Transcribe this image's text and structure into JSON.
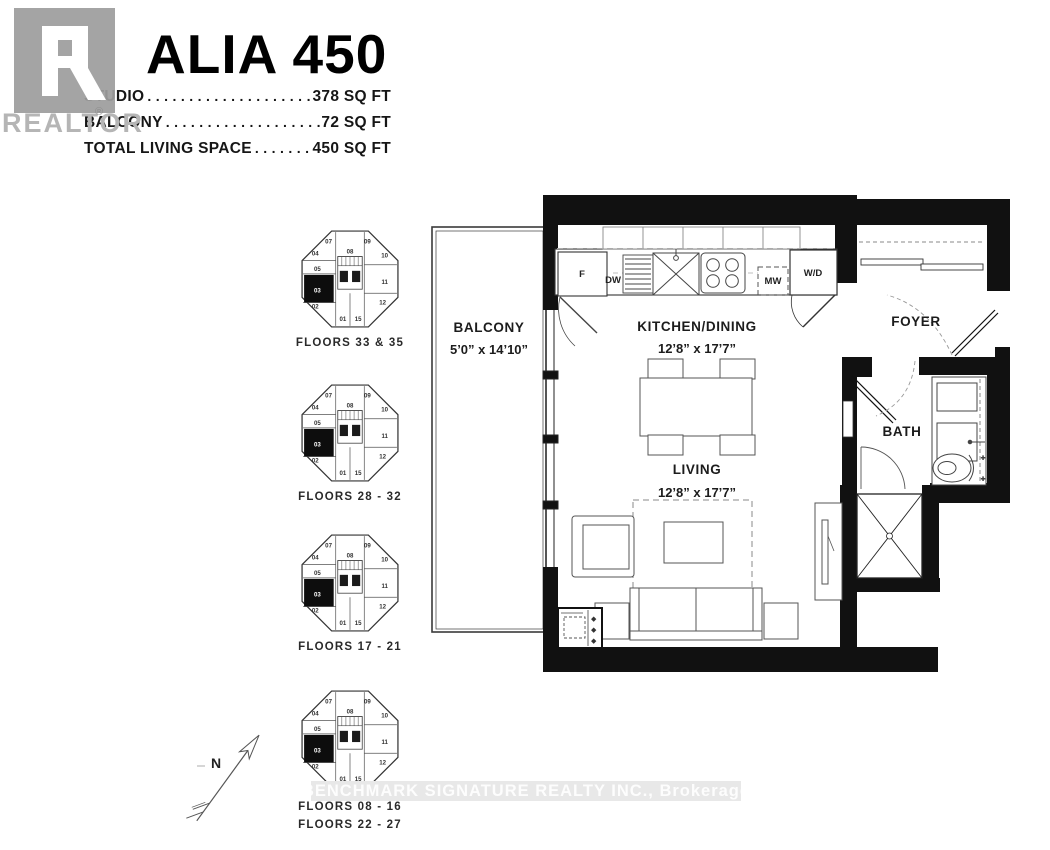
{
  "header": {
    "title": "ALIA 450",
    "specs": [
      {
        "label": "STUDIO",
        "leader": ". . . . . . . . . . . . . . . . . . . . . . . . . . . . . . . .",
        "value": "378 SQ FT"
      },
      {
        "label": "BALCONY",
        "leader": ". . . . . . . . . . . . . . . . . . . . . . . . . . . . . . . .",
        "value": "72 SQ FT"
      },
      {
        "label": "TOTAL LIVING SPACE",
        "leader": ". . . . . . . . . . . . . . . .",
        "value": "450 SQ FT"
      }
    ]
  },
  "watermarks": {
    "realtor": "REALTOR",
    "registered": "®",
    "brokerage": "BENCHMARK SIGNATURE REALTY INC., Brokerage"
  },
  "floor_plan": {
    "balcony": {
      "name": "BALCONY",
      "dims": "5’0” x 14’10”"
    },
    "kitchen_dining": {
      "name": "KITCHEN/DINING",
      "dims": "12’8” x 17’7”"
    },
    "living": {
      "name": "LIVING",
      "dims": "12’8” x 17’7”"
    },
    "foyer": {
      "name": "FOYER"
    },
    "bath": {
      "name": "BATH"
    },
    "appliances": {
      "fridge": "F",
      "dishwasher": "DW",
      "microwave": "MW",
      "washer_dryer": "W/D"
    }
  },
  "key_plans": {
    "unit_numbers": [
      {
        "id": "07",
        "x": 29,
        "y": 15
      },
      {
        "id": "09",
        "x": 67,
        "y": 15
      },
      {
        "id": "04",
        "x": 16,
        "y": 27
      },
      {
        "id": "10",
        "x": 84,
        "y": 29
      },
      {
        "id": "05",
        "x": 18,
        "y": 42
      },
      {
        "id": "08",
        "x": 50,
        "y": 25
      },
      {
        "id": "11",
        "x": 84,
        "y": 55
      },
      {
        "id": "02",
        "x": 16,
        "y": 79
      },
      {
        "id": "12",
        "x": 82,
        "y": 75
      },
      {
        "id": "01",
        "x": 43,
        "y": 91
      },
      {
        "id": "15",
        "x": 58,
        "y": 91
      }
    ],
    "highlighted_unit": {
      "id": "03",
      "x": 18,
      "y": 63
    },
    "plans": [
      {
        "labels": [
          "FLOORS 33 & 35"
        ]
      },
      {
        "labels": [
          "FLOORS 28 - 32"
        ]
      },
      {
        "labels": [
          "FLOORS 17 - 21"
        ]
      },
      {
        "labels": [
          "FLOORS 08 - 16",
          "FLOORS 22 - 27"
        ]
      }
    ]
  },
  "north_arrow": {
    "label": "N"
  },
  "colors": {
    "wall": "#111111",
    "band": "#e8e8e8",
    "watermark_gray": "#b5b5b5",
    "logo_gray": "#9d9d9d"
  }
}
